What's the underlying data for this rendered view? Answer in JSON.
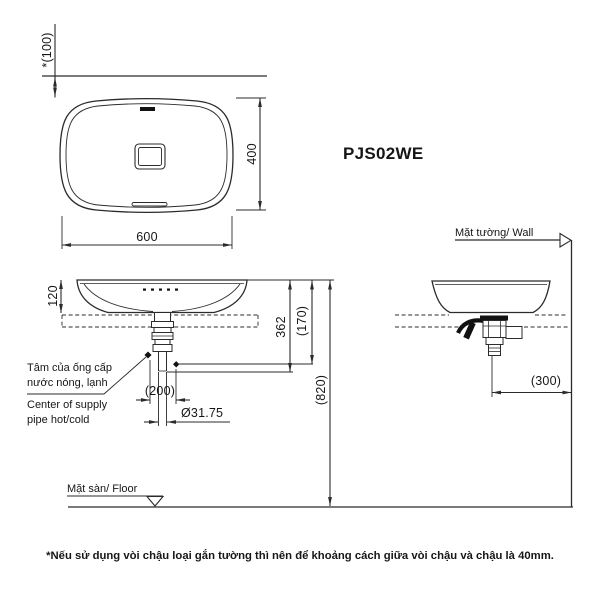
{
  "title": "PJS02WE",
  "plan": {
    "dim_wall_offset": "*(100)",
    "dim_width": "600",
    "dim_height": "400"
  },
  "front": {
    "dim_rim_height": "120",
    "dim_362": "362",
    "dim_170": "(170)",
    "dim_820": "(820)",
    "dim_200": "(200)",
    "dim_pipe_diameter": "Ø31.75",
    "supply_label_vi_1": "Tâm của ống cấp",
    "supply_label_vi_2": "nước nóng, lạnh",
    "supply_label_en_1": "Center of supply",
    "supply_label_en_2": "pipe hot/cold",
    "floor_label": "Mặt sàn/ Floor"
  },
  "side": {
    "dim_300": "(300)",
    "wall_label": "Mặt tường/ Wall"
  },
  "footnote": "*Nếu sử dụng vòi chậu loại gắn tường thì nên để khoảng cách giữa vòi chậu và chậu là 40mm.",
  "colors": {
    "line": "#2b2b2b",
    "text": "#161616",
    "background": "#ffffff"
  }
}
